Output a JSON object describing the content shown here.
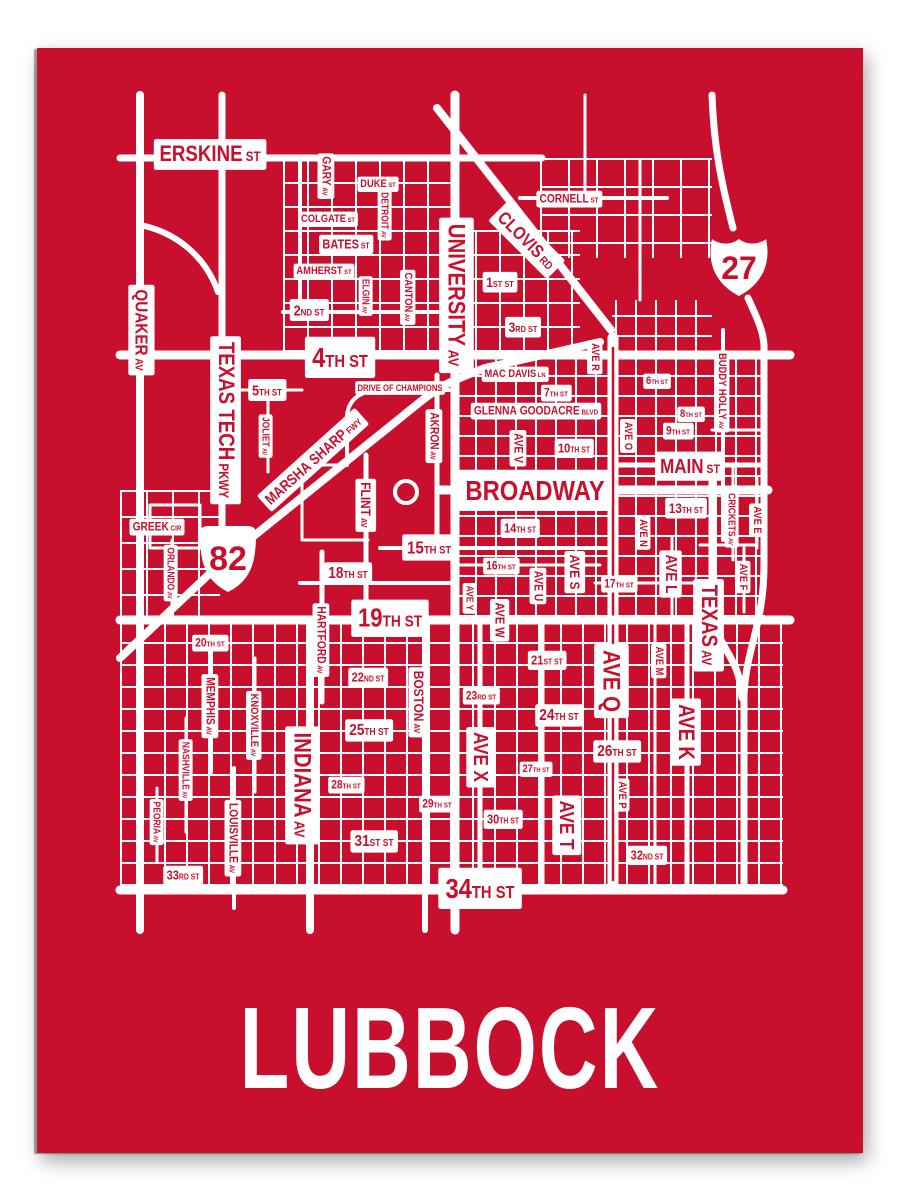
{
  "title": "LUBBOCK",
  "colors": {
    "poster_red": "#C8102E",
    "street_white": "#FFFFFF"
  },
  "map": {
    "shields": {
      "interstate_number": "27",
      "us_route_number": "82"
    },
    "labels": [
      {
        "t": "ERSKINE ST",
        "x": 210,
        "y": 153,
        "o": "h",
        "s": 22
      },
      {
        "t": "QUAKER AV",
        "x": 142,
        "y": 330,
        "o": "v",
        "s": 18
      },
      {
        "t": "GARY AV",
        "x": 327,
        "y": 176,
        "o": "v",
        "s": 12
      },
      {
        "t": "DUKE ST",
        "x": 378,
        "y": 183,
        "o": "h",
        "s": 11
      },
      {
        "t": "DETROIT AV",
        "x": 385,
        "y": 215,
        "o": "v",
        "s": 10
      },
      {
        "t": "COLGATE ST",
        "x": 328,
        "y": 218,
        "o": "h",
        "s": 11
      },
      {
        "t": "BATES ST",
        "x": 346,
        "y": 244,
        "o": "h",
        "s": 13
      },
      {
        "t": "AMHERST ST",
        "x": 324,
        "y": 270,
        "o": "h",
        "s": 11
      },
      {
        "t": "ELGIN AV",
        "x": 366,
        "y": 296,
        "o": "v",
        "s": 10
      },
      {
        "t": "CANTON AV",
        "x": 409,
        "y": 297,
        "o": "v",
        "s": 11
      },
      {
        "t": "2ND ST",
        "x": 309,
        "y": 310,
        "o": "h",
        "s": 15
      },
      {
        "t": "CORNELL ST",
        "x": 569,
        "y": 198,
        "o": "h",
        "s": 12
      },
      {
        "t": "CLOVIS RD",
        "x": 527,
        "y": 240,
        "o": 45,
        "s": 18
      },
      {
        "t": "UNIVERSITY AV",
        "x": 457,
        "y": 295,
        "o": "v",
        "s": 24
      },
      {
        "t": "1ST ST",
        "x": 500,
        "y": 282,
        "o": "h",
        "s": 14
      },
      {
        "t": "3RD ST",
        "x": 523,
        "y": 327,
        "o": "h",
        "s": 14
      },
      {
        "t": "4TH ST",
        "x": 340,
        "y": 357,
        "o": "h",
        "s": 28
      },
      {
        "t": "TEXAS TECH PKWY",
        "x": 227,
        "y": 420,
        "o": "v",
        "s": 22
      },
      {
        "t": "5TH ST",
        "x": 267,
        "y": 390,
        "o": "h",
        "s": 15
      },
      {
        "t": "JOLIET AV",
        "x": 266,
        "y": 436,
        "o": "v",
        "s": 10
      },
      {
        "t": "DRIVE OF CHAMPIONS",
        "x": 400,
        "y": 388,
        "o": "h",
        "s": 9
      },
      {
        "t": "MARSHA SHARP FWY",
        "x": 313,
        "y": 460,
        "o": -42,
        "s": 15
      },
      {
        "t": "MAC DAVIS LN",
        "x": 515,
        "y": 373,
        "o": "h",
        "s": 11
      },
      {
        "t": "7TH ST",
        "x": 556,
        "y": 392,
        "o": "h",
        "s": 12
      },
      {
        "t": "GLENNA GOODACRE BLVD",
        "x": 536,
        "y": 410,
        "o": "h",
        "s": 12
      },
      {
        "t": "AVE V",
        "x": 519,
        "y": 448,
        "o": "v",
        "s": 12
      },
      {
        "t": "10TH ST",
        "x": 574,
        "y": 448,
        "o": "h",
        "s": 13
      },
      {
        "t": "AKRON AV",
        "x": 435,
        "y": 436,
        "o": "v",
        "s": 12
      },
      {
        "t": "AVE R",
        "x": 596,
        "y": 357,
        "o": "v",
        "s": 11
      },
      {
        "t": "6TH ST",
        "x": 657,
        "y": 380,
        "o": "h",
        "s": 11
      },
      {
        "t": "8TH ST",
        "x": 691,
        "y": 413,
        "o": "h",
        "s": 11
      },
      {
        "t": "9TH ST",
        "x": 678,
        "y": 430,
        "o": "h",
        "s": 12
      },
      {
        "t": "AVE O",
        "x": 629,
        "y": 436,
        "o": "v",
        "s": 11
      },
      {
        "t": "BUDDY HOLLY AV",
        "x": 723,
        "y": 391,
        "o": "v",
        "s": 11
      },
      {
        "t": "MAIN ST",
        "x": 690,
        "y": 466,
        "o": "h",
        "s": 20
      },
      {
        "t": "BROADWAY",
        "x": 535,
        "y": 490,
        "o": "h",
        "s": 28
      },
      {
        "t": "GREEK CIR",
        "x": 157,
        "y": 526,
        "o": "h",
        "s": 12
      },
      {
        "t": "ORLANDO AV",
        "x": 171,
        "y": 573,
        "o": "v",
        "s": 10
      },
      {
        "t": "FLINT AV",
        "x": 366,
        "y": 505,
        "o": "v",
        "s": 14
      },
      {
        "t": "13TH ST",
        "x": 686,
        "y": 508,
        "o": "h",
        "s": 14
      },
      {
        "t": "CRICKETS AV",
        "x": 732,
        "y": 519,
        "o": "v",
        "s": 10
      },
      {
        "t": "AVE E",
        "x": 758,
        "y": 520,
        "o": "v",
        "s": 11
      },
      {
        "t": "AVE F",
        "x": 744,
        "y": 577,
        "o": "v",
        "s": 11
      },
      {
        "t": "AVE N",
        "x": 644,
        "y": 533,
        "o": "v",
        "s": 11
      },
      {
        "t": "AVE L",
        "x": 672,
        "y": 574,
        "o": "v",
        "s": 16
      },
      {
        "t": "14TH ST",
        "x": 520,
        "y": 528,
        "o": "h",
        "s": 13
      },
      {
        "t": "15TH ST",
        "x": 429,
        "y": 547,
        "o": "h",
        "s": 18
      },
      {
        "t": "16TH ST",
        "x": 501,
        "y": 565,
        "o": "h",
        "s": 12
      },
      {
        "t": "AVE U",
        "x": 539,
        "y": 586,
        "o": "v",
        "s": 12
      },
      {
        "t": "AVE S",
        "x": 575,
        "y": 572,
        "o": "v",
        "s": 14
      },
      {
        "t": "17TH ST",
        "x": 619,
        "y": 583,
        "o": "h",
        "s": 12
      },
      {
        "t": "18TH ST",
        "x": 348,
        "y": 572,
        "o": "h",
        "s": 16
      },
      {
        "t": "AVE Y",
        "x": 470,
        "y": 598,
        "o": "v",
        "s": 10
      },
      {
        "t": "AVE W",
        "x": 500,
        "y": 620,
        "o": "v",
        "s": 13
      },
      {
        "t": "HARTFORD AV",
        "x": 322,
        "y": 640,
        "o": "v",
        "s": 12
      },
      {
        "t": "19TH ST",
        "x": 390,
        "y": 617,
        "o": "h",
        "s": 26
      },
      {
        "t": "TEXAS AV",
        "x": 710,
        "y": 625,
        "o": "v",
        "s": 22
      },
      {
        "t": "20TH ST",
        "x": 210,
        "y": 642,
        "o": "h",
        "s": 12
      },
      {
        "t": "MEMPHIS AV",
        "x": 211,
        "y": 706,
        "o": "v",
        "s": 12
      },
      {
        "t": "KNOXVILLE AV",
        "x": 255,
        "y": 725,
        "o": "v",
        "s": 11
      },
      {
        "t": "NASHVILLE AV",
        "x": 186,
        "y": 770,
        "o": "v",
        "s": 10
      },
      {
        "t": "21ST ST",
        "x": 547,
        "y": 660,
        "o": "h",
        "s": 13
      },
      {
        "t": "22ND ST",
        "x": 368,
        "y": 677,
        "o": "h",
        "s": 13
      },
      {
        "t": "BOSTON AV",
        "x": 419,
        "y": 702,
        "o": "v",
        "s": 14
      },
      {
        "t": "23RD ST",
        "x": 481,
        "y": 695,
        "o": "h",
        "s": 12
      },
      {
        "t": "24TH ST",
        "x": 559,
        "y": 714,
        "o": "h",
        "s": 16
      },
      {
        "t": "25TH ST",
        "x": 369,
        "y": 729,
        "o": "h",
        "s": 16
      },
      {
        "t": "AVE X",
        "x": 481,
        "y": 757,
        "o": "v",
        "s": 20
      },
      {
        "t": "AVE Q",
        "x": 612,
        "y": 681,
        "o": "v",
        "s": 24
      },
      {
        "t": "AVE M",
        "x": 660,
        "y": 661,
        "o": "v",
        "s": 11
      },
      {
        "t": "AVE K",
        "x": 687,
        "y": 732,
        "o": "v",
        "s": 22
      },
      {
        "t": "26TH ST",
        "x": 617,
        "y": 750,
        "o": "h",
        "s": 16
      },
      {
        "t": "27TH ST",
        "x": 536,
        "y": 768,
        "o": "h",
        "s": 11
      },
      {
        "t": "INDIANA AV",
        "x": 303,
        "y": 785,
        "o": "v",
        "s": 24
      },
      {
        "t": "28TH ST",
        "x": 346,
        "y": 784,
        "o": "h",
        "s": 12
      },
      {
        "t": "29TH ST",
        "x": 437,
        "y": 803,
        "o": "h",
        "s": 12
      },
      {
        "t": "30TH ST",
        "x": 503,
        "y": 819,
        "o": "h",
        "s": 13
      },
      {
        "t": "AVE T",
        "x": 567,
        "y": 825,
        "o": "v",
        "s": 20
      },
      {
        "t": "AVE P",
        "x": 623,
        "y": 795,
        "o": "v",
        "s": 11
      },
      {
        "t": "31ST ST",
        "x": 374,
        "y": 840,
        "o": "h",
        "s": 16
      },
      {
        "t": "32ND ST",
        "x": 647,
        "y": 855,
        "o": "h",
        "s": 13
      },
      {
        "t": "LOUISVILLE AV",
        "x": 234,
        "y": 838,
        "o": "v",
        "s": 12
      },
      {
        "t": "PEORIA AV",
        "x": 157,
        "y": 822,
        "o": "v",
        "s": 10
      },
      {
        "t": "33RD ST",
        "x": 183,
        "y": 875,
        "o": "h",
        "s": 13
      },
      {
        "t": "34TH ST",
        "x": 480,
        "y": 888,
        "o": "h",
        "s": 28
      }
    ]
  }
}
